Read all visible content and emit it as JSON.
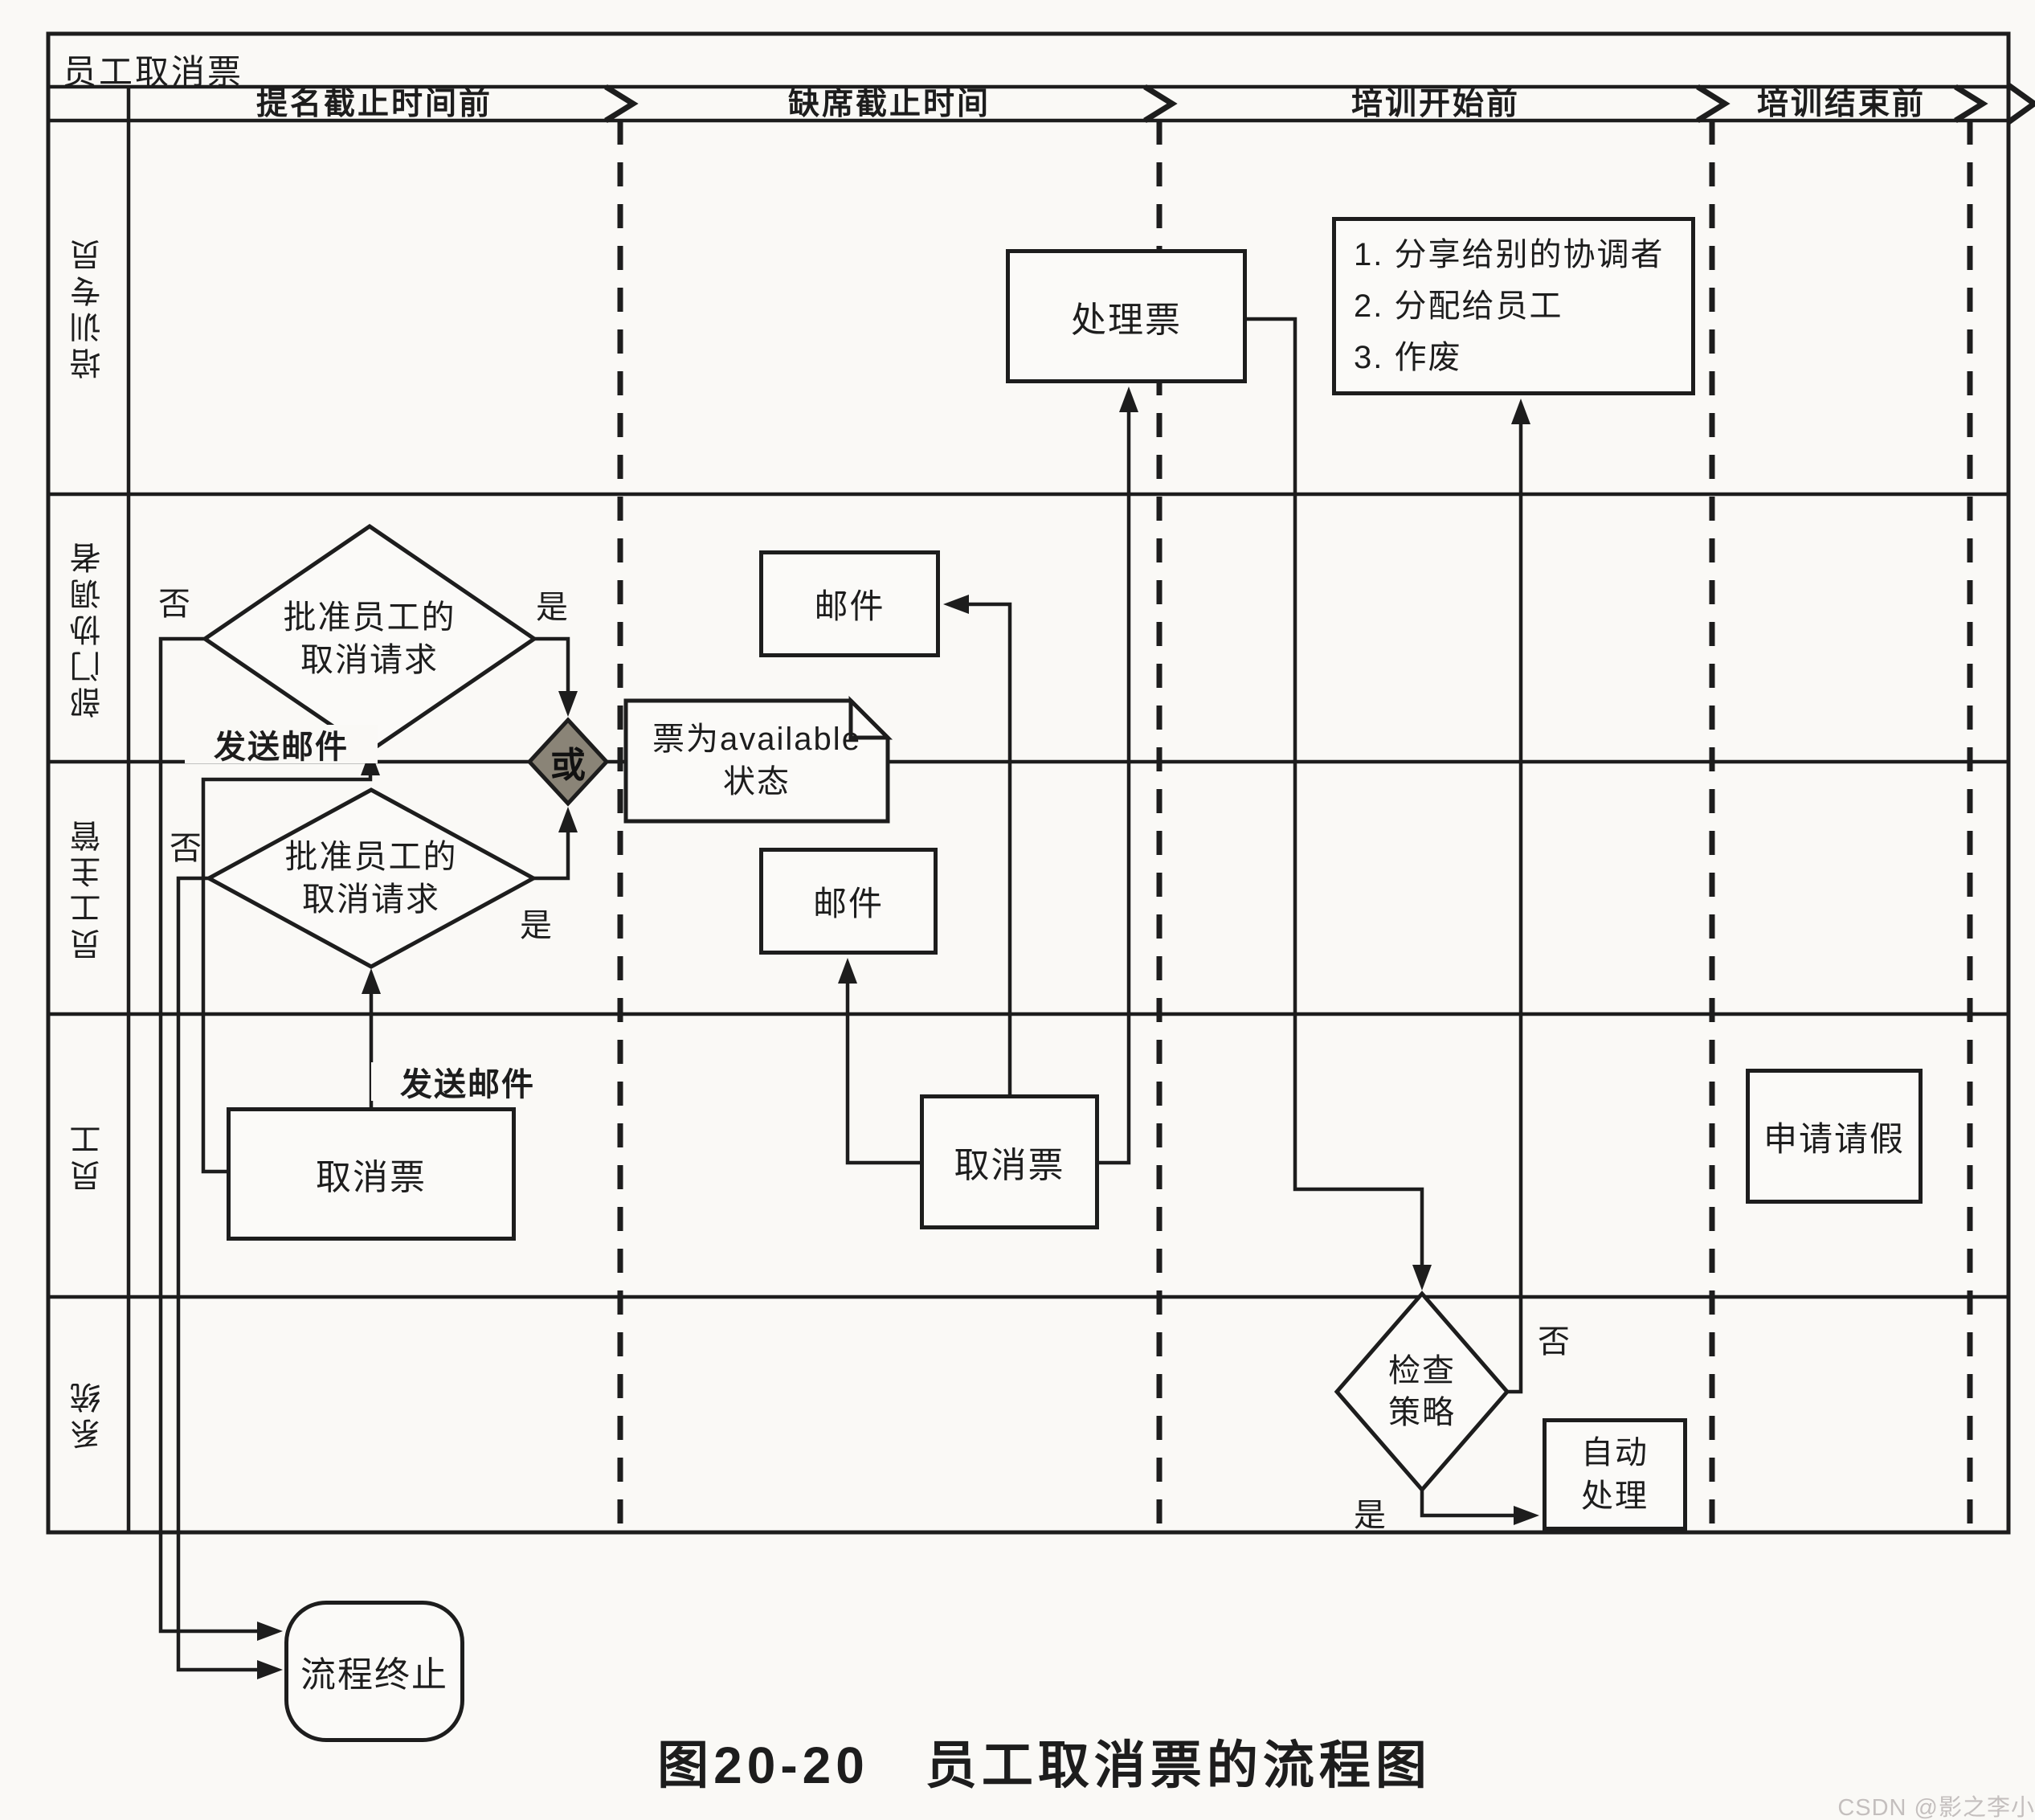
{
  "title": "员工取消票",
  "phases": [
    {
      "label": "提名截止时间前"
    },
    {
      "label": "缺席截止时间"
    },
    {
      "label": "培训开始前"
    },
    {
      "label": "培训结束前"
    }
  ],
  "lanes": [
    {
      "label": "培训专员"
    },
    {
      "label": "部门协调者"
    },
    {
      "label": "员工主管"
    },
    {
      "label": "员工"
    },
    {
      "label": "系统"
    }
  ],
  "nodes": {
    "handle_ticket": {
      "label": "处理票"
    },
    "ticket_options": {
      "items": [
        "1. 分享给别的协调者",
        "2. 分配给员工",
        "3. 作废"
      ]
    },
    "approve_coordinator": {
      "line1": "批准员工的",
      "line2": "取消请求"
    },
    "approve_supervisor": {
      "line1": "批准员工的",
      "line2": "取消请求"
    },
    "or_gate": {
      "label": "或"
    },
    "ticket_available": {
      "line1": "票为available",
      "line2": "状态"
    },
    "mail_coordinator": {
      "label": "邮件"
    },
    "mail_supervisor": {
      "label": "邮件"
    },
    "cancel_ticket_early": {
      "label": "取消票"
    },
    "cancel_ticket_late": {
      "label": "取消票"
    },
    "apply_leave": {
      "label": "申请请假"
    },
    "check_policy": {
      "line1": "检查",
      "line2": "策略"
    },
    "auto_handle": {
      "line1": "自动",
      "line2": "处理"
    },
    "process_end": {
      "label": "流程终止"
    }
  },
  "edge_labels": {
    "no_coordinator": "否",
    "yes_coordinator": "是",
    "no_supervisor": "否",
    "yes_supervisor": "是",
    "send_mail_coordinator": "发送邮件",
    "send_mail_supervisor": "发送邮件",
    "no_policy": "否",
    "yes_policy": "是"
  },
  "caption": "图20-20　员工取消票的流程图",
  "watermark": "CSDN @影之李小白",
  "colors": {
    "line": "#1d1d1d",
    "or_fill": "#8a8477",
    "paper": "#fbfaf8",
    "watermark": "#c4bfbe"
  }
}
